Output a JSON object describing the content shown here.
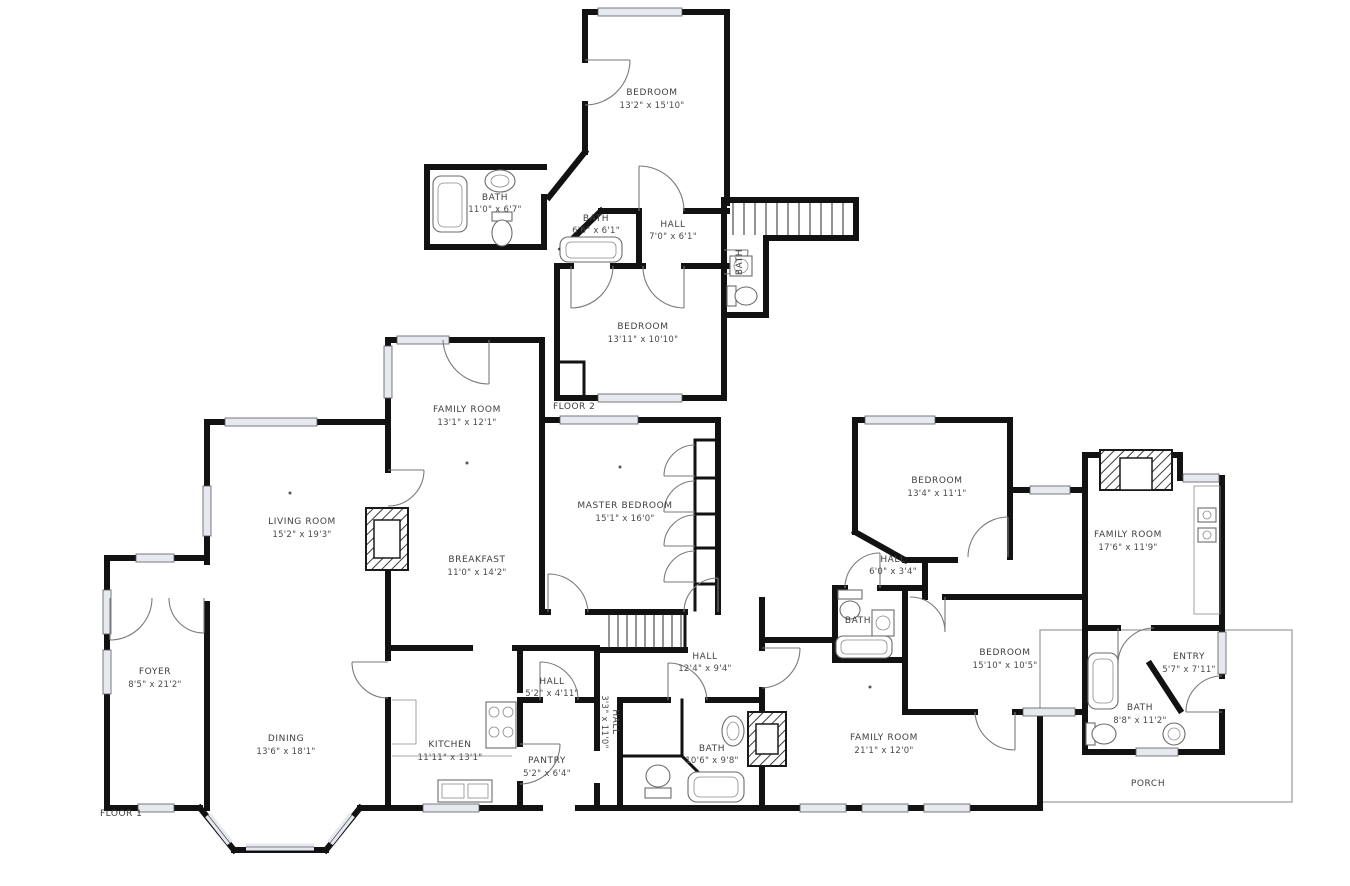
{
  "colors": {
    "wall": "#121212",
    "window_fill": "#e6e9f0",
    "door_stroke": "#7a7a7a",
    "label_text": "#3f3f3f",
    "porch_stroke": "#9a9a9a",
    "background": "#ffffff"
  },
  "floor2": {
    "label": "FLOOR 2",
    "rooms": {
      "bedroom_top": {
        "name": "BEDROOM",
        "dims": "13'2\" x 15'10\""
      },
      "bath_large": {
        "name": "BATH",
        "dims": "11'0\" x 6'7\""
      },
      "bath_small": {
        "name": "BATH",
        "dims": "6'6\" x 6'1\""
      },
      "hall": {
        "name": "HALL",
        "dims": "7'0\" x 6'1\""
      },
      "bedroom_lower": {
        "name": "BEDROOM",
        "dims": "13'11\" x 10'10\""
      },
      "bath_stairs": {
        "name": "BATH",
        "dims": ""
      }
    }
  },
  "floor1": {
    "label": "FLOOR 1",
    "rooms": {
      "family_room_left": {
        "name": "FAMILY ROOM",
        "dims": "13'1\" x 12'1\""
      },
      "living_room": {
        "name": "LIVING ROOM",
        "dims": "15'2\" x 19'3\""
      },
      "foyer": {
        "name": "FOYER",
        "dims": "8'5\" x 21'2\""
      },
      "dining": {
        "name": "DINING",
        "dims": "13'6\" x 18'1\""
      },
      "breakfast": {
        "name": "BREAKFAST",
        "dims": "11'0\" x 14'2\""
      },
      "kitchen": {
        "name": "KITCHEN",
        "dims": "11'11\" x 13'1\""
      },
      "hall_kitchen": {
        "name": "HALL",
        "dims": "5'2\" x 4'11\""
      },
      "pantry": {
        "name": "PANTRY",
        "dims": "5'2\" x 6'4\""
      },
      "hall_narrow": {
        "name": "HALL",
        "dims": "3'3\" x 11'0\""
      },
      "master_bedroom": {
        "name": "MASTER BEDROOM",
        "dims": "15'1\" x 16'0\""
      },
      "hall_center": {
        "name": "HALL",
        "dims": "12'4\" x 9'4\""
      },
      "bath_center": {
        "name": "BATH",
        "dims": "10'6\" x 9'8\""
      },
      "bedroom_right_upper": {
        "name": "BEDROOM",
        "dims": "13'4\" x 11'1\""
      },
      "hall_right": {
        "name": "HALL",
        "dims": "6'0\" x 3'4\""
      },
      "bath_right_small": {
        "name": "BATH",
        "dims": ""
      },
      "bedroom_right_lower": {
        "name": "BEDROOM",
        "dims": "15'10\" x 10'5\""
      },
      "family_room_bottom": {
        "name": "FAMILY ROOM",
        "dims": "21'1\" x 12'0\""
      },
      "family_room_right": {
        "name": "FAMILY ROOM",
        "dims": "17'6\" x 11'9\""
      },
      "entry": {
        "name": "ENTRY",
        "dims": "5'7\" x 7'11\""
      },
      "bath_right": {
        "name": "BATH",
        "dims": "8'8\" x 11'2\""
      },
      "porch": {
        "name": "PORCH",
        "dims": ""
      }
    }
  }
}
